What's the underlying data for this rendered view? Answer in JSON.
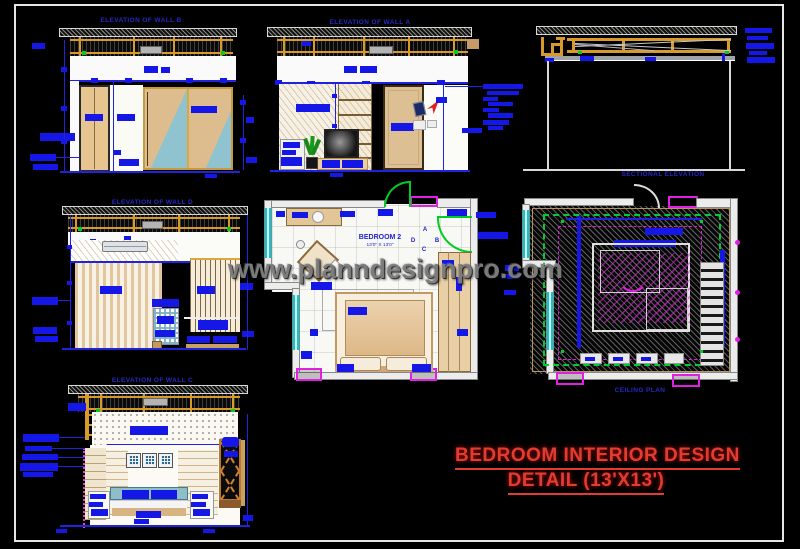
{
  "sheet": {
    "watermark": "www.planndesignpro.com",
    "title_line1": "BEDROOM INTERIOR DESIGN",
    "title_line2": "DETAIL (13'X13')"
  },
  "views": {
    "wall_b": {
      "title": "ELEVATION OF WALL B"
    },
    "wall_a": {
      "title": "ELEVATION OF WALL A"
    },
    "sectional": {
      "title": "SECTIONAL ELEVATION"
    },
    "wall_d": {
      "title": "ELEVATION OF WALL D"
    },
    "wall_c": {
      "title": "ELEVATION OF WALL C"
    },
    "ceiling": {
      "title": "CEILING PLAN"
    },
    "plan": {
      "room_name": "BEDROOM 2",
      "room_size": "13'0\" X 13'0\"",
      "markers": {
        "a": "A",
        "b": "B",
        "c": "C",
        "d": "D"
      }
    }
  },
  "colors": {
    "cad_blue": "#1417e6",
    "title_red": "#e23c30",
    "wood_tan": "#e2c694",
    "teal": "#8fc3cf",
    "frame_orange": "#d79a2b",
    "magenta": "#e020e0",
    "green": "#00cc22",
    "cyan": "#00ccd4",
    "watermark_gray": "#7d7d7d"
  }
}
